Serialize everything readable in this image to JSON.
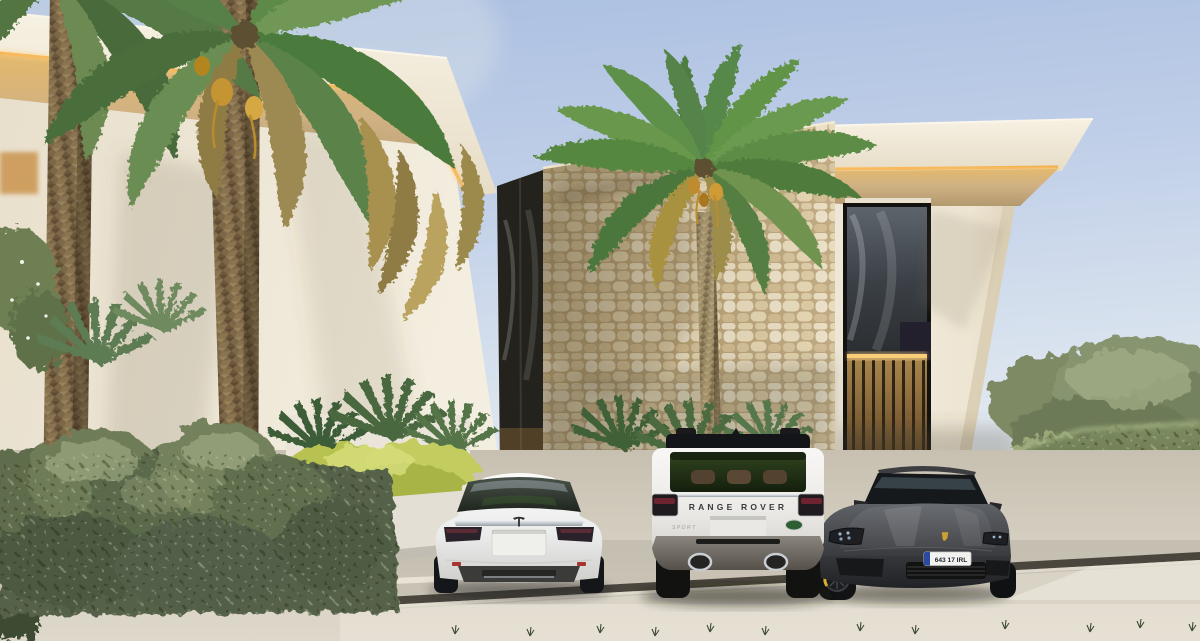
{
  "scene": {
    "type": "architectural exterior render",
    "subject": "modern luxury villa driveway with three parked cars, palm trees and hedges"
  },
  "vehicles": {
    "tesla": {
      "body_color": "white",
      "badge": "tesla-t-logo"
    },
    "range_rover": {
      "tailgate_text": "RANGE ROVER",
      "model_badge_text": "SPORT",
      "brand_badge": "land-rover-green-oval",
      "body_color": "white",
      "roof_color": "black"
    },
    "porsche": {
      "license_plate_text": "643 17 IRL",
      "plate_band": "eu-blue-band",
      "brand_badge": "porsche-crest",
      "body_color": "graphite grey"
    }
  },
  "palette": {
    "sky_top": "#a9bee0",
    "sky_horizon": "#edf1f3",
    "villa_cream": "#efe8d9",
    "led_accent": "#f0a843",
    "stone_beige": "#d9cba6",
    "foliage_dark": "#46543a",
    "foliage_light": "#8fa06b",
    "hedge_yellow": "#b8c251",
    "driveway_grey": "#d6d0c3",
    "drain_strip": "#4a463e"
  }
}
